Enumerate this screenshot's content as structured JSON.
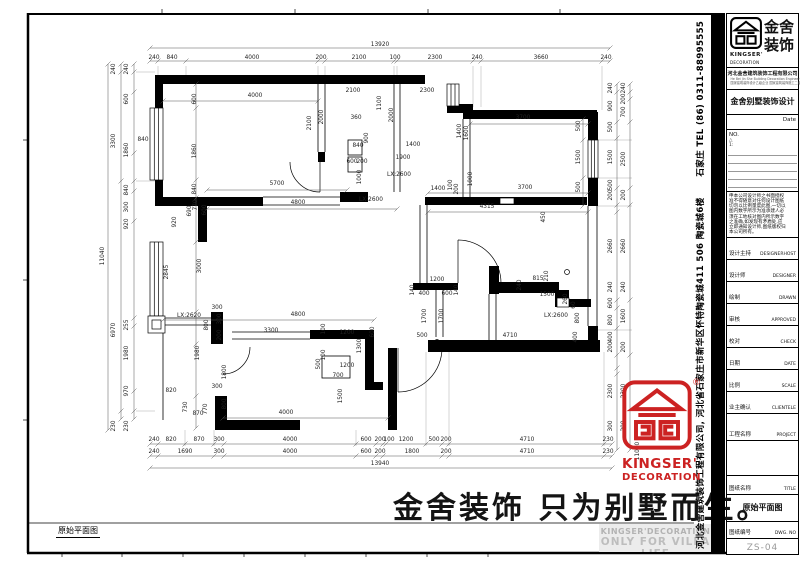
{
  "sheet": {
    "bottom_left_label": "原始平面图",
    "watermark": "金舍装饰 只为别墅而生。",
    "side_company": "河北金舍建筑装饰工程有限公司, 河北省石家庄市新华区怀特陶瓷城411 506 陶瓷城6楼",
    "side_tel": "石家庄 TEL (86) 0311-88995555",
    "accent_red": "#cc2222",
    "footer_en1": "KINGSER'DECORATION",
    "footer_en2": "ONLY FOR VILLA LIFE",
    "stamp_line1": "KINGSER'",
    "stamp_line2": "DECORATION",
    "stamp_reg": "®"
  },
  "titleblock": {
    "logo_cn1": "金舍",
    "logo_cn2": "装饰",
    "logo_en1": "KINGSER'",
    "logo_en2": "DECORATION",
    "company": "河北金舍建筑装饰工程有限公司",
    "company_en": "He Bei Jin She Building Decoration Engineering Co., Ltd",
    "company_cert": "国家建筑装饰设计乙级企业 国家建筑装饰施工二级企业",
    "villa_line": "金舍别墅装饰设计",
    "date_label": "Date",
    "no_label": "NO.",
    "rev1": "△",
    "rev2": "1:",
    "notice_lines": [
      "申本公司设计师之书面授权",
      "准不得随意对任何设计图纸",
      "切勿以比例量度此图,一切以",
      "图内数字所示为准承建人必",
      "须在工地核对图内所示数字",
      "之准确,如发现有矛盾处,应",
      "立即通知设计师,图纸版权归",
      "本公司所有。"
    ],
    "fields": [
      {
        "cn": "设计主持",
        "en": "DESIGNERHOST"
      },
      {
        "cn": "设计师",
        "en": "DESIGNER"
      },
      {
        "cn": "绘制",
        "en": "DRAWN"
      },
      {
        "cn": "审核",
        "en": "APPROVED"
      },
      {
        "cn": "校对",
        "en": "CHECK"
      },
      {
        "cn": "日期",
        "en": "DATE"
      },
      {
        "cn": "比例",
        "en": "SCALE"
      },
      {
        "cn": "业主确认",
        "en": "CLIENTELE"
      }
    ],
    "project_cn": "工程名称",
    "project_en": "PROJECT",
    "title_cn": "图纸名称",
    "title_en": "TITLE",
    "drawing_name": "原始平面图",
    "dwg_cn": "图纸编号",
    "dwg_en": "DWG. NO",
    "dwg_no": "ZS-04"
  },
  "plan": {
    "dims": [
      {
        "t": "13920",
        "x": 380,
        "y": 46
      },
      {
        "t": "240",
        "x": 154,
        "y": 59
      },
      {
        "t": "840",
        "x": 172,
        "y": 59
      },
      {
        "t": "4000",
        "x": 252,
        "y": 59
      },
      {
        "t": "200",
        "x": 321,
        "y": 59
      },
      {
        "t": "2100",
        "x": 359,
        "y": 59
      },
      {
        "t": "100",
        "x": 395,
        "y": 59
      },
      {
        "t": "2300",
        "x": 435,
        "y": 59
      },
      {
        "t": "240",
        "x": 477,
        "y": 59
      },
      {
        "t": "3660",
        "x": 541,
        "y": 59
      },
      {
        "t": "240",
        "x": 606,
        "y": 59
      },
      {
        "t": "240",
        "x": 154,
        "y": 441
      },
      {
        "t": "820",
        "x": 171,
        "y": 441
      },
      {
        "t": "870",
        "x": 199,
        "y": 441
      },
      {
        "t": "300",
        "x": 219,
        "y": 441
      },
      {
        "t": "4000",
        "x": 290,
        "y": 441
      },
      {
        "t": "600",
        "x": 366,
        "y": 441
      },
      {
        "t": "200",
        "x": 380,
        "y": 441
      },
      {
        "t": "100",
        "x": 389,
        "y": 441
      },
      {
        "t": "1200",
        "x": 406,
        "y": 441
      },
      {
        "t": "500",
        "x": 434,
        "y": 441
      },
      {
        "t": "200",
        "x": 446,
        "y": 441
      },
      {
        "t": "4710",
        "x": 527,
        "y": 441
      },
      {
        "t": "230",
        "x": 608,
        "y": 441
      },
      {
        "t": "240",
        "x": 154,
        "y": 453
      },
      {
        "t": "1690",
        "x": 185,
        "y": 453
      },
      {
        "t": "300",
        "x": 219,
        "y": 453
      },
      {
        "t": "4000",
        "x": 290,
        "y": 453
      },
      {
        "t": "600",
        "x": 366,
        "y": 453
      },
      {
        "t": "200",
        "x": 380,
        "y": 453
      },
      {
        "t": "1800",
        "x": 412,
        "y": 453
      },
      {
        "t": "200",
        "x": 446,
        "y": 453
      },
      {
        "t": "4710",
        "x": 527,
        "y": 453
      },
      {
        "t": "230",
        "x": 608,
        "y": 453
      },
      {
        "t": "13940",
        "x": 380,
        "y": 465
      },
      {
        "t": "11040",
        "x": 104,
        "y": 256,
        "v": 1
      },
      {
        "t": "240",
        "x": 115,
        "y": 69,
        "v": 1
      },
      {
        "t": "3300",
        "x": 115,
        "y": 141,
        "v": 1
      },
      {
        "t": "6970",
        "x": 115,
        "y": 330,
        "v": 1
      },
      {
        "t": "230",
        "x": 115,
        "y": 426,
        "v": 1
      },
      {
        "t": "240",
        "x": 128,
        "y": 69,
        "v": 1
      },
      {
        "t": "600",
        "x": 128,
        "y": 99,
        "v": 1
      },
      {
        "t": "1860",
        "x": 128,
        "y": 150,
        "v": 1
      },
      {
        "t": "840",
        "x": 128,
        "y": 190,
        "v": 1
      },
      {
        "t": "300",
        "x": 128,
        "y": 207,
        "v": 1
      },
      {
        "t": "920",
        "x": 128,
        "y": 224,
        "v": 1
      },
      {
        "t": "255",
        "x": 128,
        "y": 325,
        "v": 1
      },
      {
        "t": "1980",
        "x": 128,
        "y": 353,
        "v": 1
      },
      {
        "t": "970",
        "x": 128,
        "y": 391,
        "v": 1
      },
      {
        "t": "230",
        "x": 128,
        "y": 426,
        "v": 1
      },
      {
        "t": "600",
        "x": 196,
        "y": 99,
        "v": 1
      },
      {
        "t": "1860",
        "x": 196,
        "y": 151,
        "v": 1
      },
      {
        "t": "840",
        "x": 196,
        "y": 189,
        "v": 1
      },
      {
        "t": "3000",
        "x": 201,
        "y": 266,
        "v": 1
      },
      {
        "t": "2845",
        "x": 168,
        "y": 272,
        "v": 1
      },
      {
        "t": "1980",
        "x": 199,
        "y": 353,
        "v": 1
      },
      {
        "t": "840",
        "x": 143,
        "y": 141
      },
      {
        "t": "920",
        "x": 176,
        "y": 222,
        "v": 1
      },
      {
        "t": "240",
        "x": 612,
        "y": 88,
        "v": 1
      },
      {
        "t": "900",
        "x": 612,
        "y": 106,
        "v": 1
      },
      {
        "t": "500",
        "x": 612,
        "y": 127,
        "v": 1
      },
      {
        "t": "1500",
        "x": 612,
        "y": 157,
        "v": 1
      },
      {
        "t": "500",
        "x": 612,
        "y": 185,
        "v": 1
      },
      {
        "t": "200",
        "x": 612,
        "y": 195,
        "v": 1
      },
      {
        "t": "2660",
        "x": 612,
        "y": 246,
        "v": 1
      },
      {
        "t": "240",
        "x": 612,
        "y": 287,
        "v": 1
      },
      {
        "t": "600",
        "x": 612,
        "y": 303,
        "v": 1
      },
      {
        "t": "800",
        "x": 612,
        "y": 320,
        "v": 1
      },
      {
        "t": "400",
        "x": 612,
        "y": 337,
        "v": 1
      },
      {
        "t": "200",
        "x": 612,
        "y": 347,
        "v": 1
      },
      {
        "t": "2300",
        "x": 612,
        "y": 391,
        "v": 1
      },
      {
        "t": "300",
        "x": 612,
        "y": 426,
        "v": 1
      },
      {
        "t": "240",
        "x": 625,
        "y": 88,
        "v": 1
      },
      {
        "t": "200",
        "x": 625,
        "y": 99,
        "v": 1
      },
      {
        "t": "700",
        "x": 625,
        "y": 112,
        "v": 1
      },
      {
        "t": "2500",
        "x": 625,
        "y": 159,
        "v": 1
      },
      {
        "t": "200",
        "x": 625,
        "y": 195,
        "v": 1
      },
      {
        "t": "2660",
        "x": 625,
        "y": 246,
        "v": 1
      },
      {
        "t": "240",
        "x": 625,
        "y": 287,
        "v": 1
      },
      {
        "t": "1600",
        "x": 625,
        "y": 316,
        "v": 1
      },
      {
        "t": "200",
        "x": 625,
        "y": 347,
        "v": 1
      },
      {
        "t": "2300",
        "x": 625,
        "y": 391,
        "v": 1
      },
      {
        "t": "200",
        "x": 625,
        "y": 426,
        "v": 1
      },
      {
        "t": "11040",
        "x": 639,
        "y": 451,
        "v": 1
      },
      {
        "t": "4000",
        "x": 255,
        "y": 97
      },
      {
        "t": "2100",
        "x": 311,
        "y": 123,
        "v": 1
      },
      {
        "t": "2000",
        "x": 323,
        "y": 117,
        "v": 1
      },
      {
        "t": "2100",
        "x": 353,
        "y": 92
      },
      {
        "t": "2300",
        "x": 427,
        "y": 92
      },
      {
        "t": "1100",
        "x": 381,
        "y": 103,
        "v": 1
      },
      {
        "t": "2000",
        "x": 393,
        "y": 115,
        "v": 1
      },
      {
        "t": "360",
        "x": 356,
        "y": 119
      },
      {
        "t": "900",
        "x": 368,
        "y": 138,
        "v": 1
      },
      {
        "t": "840",
        "x": 358,
        "y": 147
      },
      {
        "t": "1400",
        "x": 413,
        "y": 146
      },
      {
        "t": "1900",
        "x": 403,
        "y": 159
      },
      {
        "t": "600",
        "x": 352,
        "y": 163
      },
      {
        "t": "200",
        "x": 362,
        "y": 163
      },
      {
        "t": "1000",
        "x": 361,
        "y": 177,
        "v": 1
      },
      {
        "t": "LX:2600",
        "x": 399,
        "y": 176
      },
      {
        "t": "LX:2600",
        "x": 371,
        "y": 201
      },
      {
        "t": "1400",
        "x": 438,
        "y": 190
      },
      {
        "t": "100",
        "x": 452,
        "y": 185,
        "v": 1
      },
      {
        "t": "200",
        "x": 458,
        "y": 189,
        "v": 1
      },
      {
        "t": "1000",
        "x": 472,
        "y": 179,
        "v": 1
      },
      {
        "t": "1400",
        "x": 461,
        "y": 131,
        "v": 1
      },
      {
        "t": "1600",
        "x": 468,
        "y": 133,
        "v": 1
      },
      {
        "t": "3700",
        "x": 523,
        "y": 119
      },
      {
        "t": "500",
        "x": 580,
        "y": 126,
        "v": 1
      },
      {
        "t": "1500",
        "x": 580,
        "y": 157,
        "v": 1
      },
      {
        "t": "500",
        "x": 580,
        "y": 187,
        "v": 1
      },
      {
        "t": "3700",
        "x": 525,
        "y": 189
      },
      {
        "t": "4315",
        "x": 487,
        "y": 208
      },
      {
        "t": "450",
        "x": 545,
        "y": 217,
        "v": 1
      },
      {
        "t": "5700",
        "x": 277,
        "y": 185
      },
      {
        "t": "4800",
        "x": 298,
        "y": 204
      },
      {
        "t": "770",
        "x": 197,
        "y": 205,
        "v": 1
      },
      {
        "t": "690",
        "x": 191,
        "y": 211,
        "v": 1
      },
      {
        "t": "600",
        "x": 206,
        "y": 210,
        "v": 1
      },
      {
        "t": "1200",
        "x": 437,
        "y": 281
      },
      {
        "t": "140",
        "x": 414,
        "y": 290,
        "v": 1
      },
      {
        "t": "400",
        "x": 424,
        "y": 295
      },
      {
        "t": "600",
        "x": 447,
        "y": 295
      },
      {
        "t": "140",
        "x": 458,
        "y": 290,
        "v": 1
      },
      {
        "t": "1700",
        "x": 426,
        "y": 316,
        "v": 1
      },
      {
        "t": "1700",
        "x": 443,
        "y": 316,
        "v": 1
      },
      {
        "t": "500",
        "x": 422,
        "y": 337
      },
      {
        "t": "815",
        "x": 538,
        "y": 280
      },
      {
        "t": "210",
        "x": 548,
        "y": 276,
        "v": 1
      },
      {
        "t": "240",
        "x": 521,
        "y": 285,
        "v": 1
      },
      {
        "t": "1500",
        "x": 547,
        "y": 296
      },
      {
        "t": "260",
        "x": 567,
        "y": 299,
        "v": 1
      },
      {
        "t": "60",
        "x": 575,
        "y": 305,
        "v": 1
      },
      {
        "t": "LX:2600",
        "x": 556,
        "y": 317
      },
      {
        "t": "800",
        "x": 579,
        "y": 318,
        "v": 1
      },
      {
        "t": "4710",
        "x": 510,
        "y": 337
      },
      {
        "t": "400",
        "x": 577,
        "y": 337,
        "v": 1
      },
      {
        "t": "4800",
        "x": 298,
        "y": 316
      },
      {
        "t": "3300",
        "x": 271,
        "y": 332
      },
      {
        "t": "100",
        "x": 325,
        "y": 329,
        "v": 1
      },
      {
        "t": "1200",
        "x": 347,
        "y": 334
      },
      {
        "t": "600",
        "x": 374,
        "y": 332,
        "v": 1
      },
      {
        "t": "1300",
        "x": 361,
        "y": 346,
        "v": 1
      },
      {
        "t": "100",
        "x": 325,
        "y": 355,
        "v": 1
      },
      {
        "t": "500",
        "x": 320,
        "y": 364,
        "v": 1
      },
      {
        "t": "1200",
        "x": 347,
        "y": 367
      },
      {
        "t": "700",
        "x": 338,
        "y": 377
      },
      {
        "t": "1500",
        "x": 342,
        "y": 396,
        "v": 1
      },
      {
        "t": "4000",
        "x": 286,
        "y": 414
      },
      {
        "t": "LX:2620",
        "x": 189,
        "y": 317
      },
      {
        "t": "300",
        "x": 217,
        "y": 309
      },
      {
        "t": "800",
        "x": 208,
        "y": 325,
        "v": 1
      },
      {
        "t": "300",
        "x": 221,
        "y": 319,
        "v": 1
      },
      {
        "t": "200",
        "x": 221,
        "y": 335,
        "v": 1
      },
      {
        "t": "1800",
        "x": 226,
        "y": 372,
        "v": 1
      },
      {
        "t": "820",
        "x": 171,
        "y": 392
      },
      {
        "t": "730",
        "x": 187,
        "y": 407,
        "v": 1
      },
      {
        "t": "870",
        "x": 198,
        "y": 415
      },
      {
        "t": "770",
        "x": 207,
        "y": 409,
        "v": 1
      },
      {
        "t": "300",
        "x": 217,
        "y": 388
      },
      {
        "t": "800",
        "x": 226,
        "y": 404,
        "v": 1
      }
    ],
    "chains": [
      {
        "d": "h",
        "p": 48,
        "t": [
          150,
          610
        ]
      },
      {
        "d": "h",
        "p": 61,
        "t": [
          150,
          158,
          186,
          318,
          325,
          394,
          397,
          473,
          481,
          602,
          610
        ]
      },
      {
        "d": "h",
        "p": 444,
        "t": [
          150,
          158,
          185,
          214,
          224,
          356,
          376,
          383,
          386,
          426,
          442,
          449,
          604,
          612
        ]
      },
      {
        "d": "h",
        "p": 456,
        "t": [
          150,
          158,
          214,
          224,
          356,
          376,
          383,
          442,
          449,
          604,
          612
        ]
      },
      {
        "d": "h",
        "p": 468,
        "t": [
          150,
          612
        ]
      },
      {
        "d": "v",
        "p": 108,
        "t": [
          64,
          430
        ]
      },
      {
        "d": "v",
        "p": 121,
        "t": [
          64,
          72,
          181,
          411,
          419
        ]
      },
      {
        "d": "v",
        "p": 134,
        "t": [
          64,
          72,
          92,
          153,
          181,
          191,
          221,
          318,
          326,
          391,
          411,
          419
        ]
      },
      {
        "d": "v",
        "p": 617,
        "t": [
          84,
          92,
          122,
          138,
          188,
          205,
          212,
          300,
          308,
          328,
          355,
          368,
          374,
          450
        ]
      },
      {
        "d": "v",
        "p": 630,
        "t": [
          84,
          92,
          99,
          122,
          188,
          205,
          300,
          355,
          450
        ]
      },
      {
        "d": "h",
        "p": 101,
        "t": [
          163,
          318
        ]
      },
      {
        "d": "h",
        "p": 124,
        "t": [
          470,
          588
        ]
      },
      {
        "d": "h",
        "p": 190,
        "t": [
          207,
          347
        ]
      },
      {
        "d": "h",
        "p": 209,
        "t": [
          207,
          397
        ]
      },
      {
        "d": "h",
        "p": 193,
        "t": [
          428,
          588
        ]
      },
      {
        "d": "h",
        "p": 212,
        "t": [
          428,
          588
        ]
      },
      {
        "d": "h",
        "p": 320,
        "t": [
          163,
          374
        ]
      },
      {
        "d": "h",
        "p": 418,
        "t": [
          223,
          388
        ]
      },
      {
        "d": "v",
        "p": 196,
        "t": [
          84,
          108,
          180,
          198,
          242,
          312,
          344,
          396,
          428
        ]
      },
      {
        "d": "v",
        "p": 583,
        "t": [
          119,
          140,
          178,
          206
        ]
      }
    ]
  }
}
